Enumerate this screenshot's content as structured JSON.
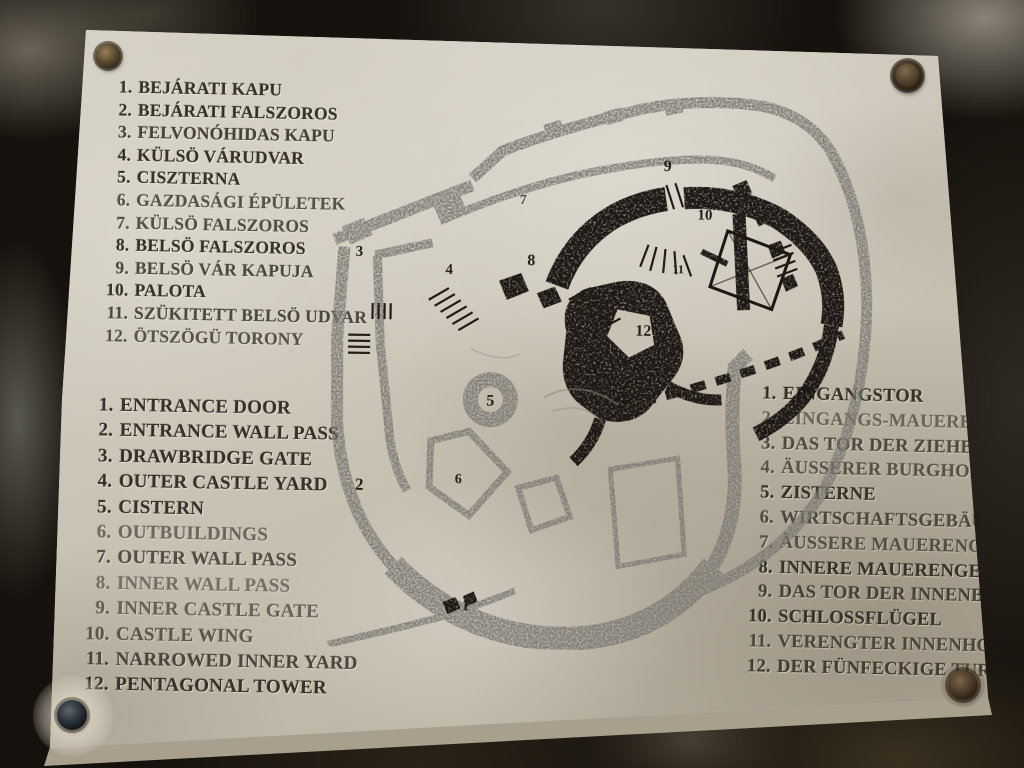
{
  "colors": {
    "plaque_stone": "#ccc6b9",
    "rock_background": "#15110c",
    "outer_wall_gray": "#7b7a74",
    "inner_castle_black": "#1b1712",
    "engraved_text": "#373127"
  },
  "legend_hu": {
    "items": [
      {
        "n": "1.",
        "t": "BEJÁRATI KAPU"
      },
      {
        "n": "2.",
        "t": "BEJÁRATI FALSZOROS"
      },
      {
        "n": "3.",
        "t": "FELVONÓHIDAS KAPU"
      },
      {
        "n": "4.",
        "t": "KÜLSÖ VÁRUDVAR"
      },
      {
        "n": "5.",
        "t": "CISZTERNA"
      },
      {
        "n": "6.",
        "t": "GAZDASÁGI ÉPÜLETEK"
      },
      {
        "n": "7.",
        "t": "KÜLSÖ FALSZOROS"
      },
      {
        "n": "8.",
        "t": "BELSÖ FALSZOROS"
      },
      {
        "n": "9.",
        "t": "BELSÖ VÁR KAPUJA"
      },
      {
        "n": "10.",
        "t": "PALOTA"
      },
      {
        "n": "11.",
        "t": "SZÜKITETT BELSÖ UDVAR"
      },
      {
        "n": "12.",
        "t": "ÖTSZÖGÜ TORONY"
      }
    ]
  },
  "legend_en": {
    "items": [
      {
        "n": "1.",
        "t": "ENTRANCE DOOR"
      },
      {
        "n": "2.",
        "t": "ENTRANCE WALL PASS"
      },
      {
        "n": "3.",
        "t": "DRAWBRIDGE GATE"
      },
      {
        "n": "4.",
        "t": "OUTER CASTLE YARD"
      },
      {
        "n": "5.",
        "t": "CISTERN"
      },
      {
        "n": "6.",
        "t": "OUTBUILDINGS"
      },
      {
        "n": "7.",
        "t": "OUTER WALL PASS"
      },
      {
        "n": "8.",
        "t": "INNER WALL PASS"
      },
      {
        "n": "9.",
        "t": "INNER CASTLE GATE"
      },
      {
        "n": "10.",
        "t": "CASTLE WING"
      },
      {
        "n": "11.",
        "t": "NARROWED INNER YARD"
      },
      {
        "n": "12.",
        "t": "PENTAGONAL TOWER"
      }
    ]
  },
  "legend_de": {
    "items": [
      {
        "n": "1.",
        "t": "EINGANGSTOR"
      },
      {
        "n": "2.",
        "t": "EINGANGS-MAUERENGE"
      },
      {
        "n": "3.",
        "t": "DAS TOR DER ZIEHBRÜCKE"
      },
      {
        "n": "4.",
        "t": "ÄUSSERER BURGHOF"
      },
      {
        "n": "5.",
        "t": "ZISTERNE"
      },
      {
        "n": "6.",
        "t": "WIRTSCHAFTSGEBÄUDE"
      },
      {
        "n": "7.",
        "t": "ÄUSSERE MAUERENGE"
      },
      {
        "n": "8.",
        "t": "INNERE MAUERENGE"
      },
      {
        "n": "9.",
        "t": "DAS TOR DER INNENBURG"
      },
      {
        "n": "10.",
        "t": "SCHLOSSFLÜGEL"
      },
      {
        "n": "11.",
        "t": "VERENGTER INNENHOF"
      },
      {
        "n": "12.",
        "t": "DER FÜNFECKIGE TURM"
      }
    ]
  },
  "map": {
    "labels": [
      {
        "n": "1"
      },
      {
        "n": "2"
      },
      {
        "n": "3"
      },
      {
        "n": "4"
      },
      {
        "n": "5"
      },
      {
        "n": "6"
      },
      {
        "n": "7"
      },
      {
        "n": "8"
      },
      {
        "n": "9"
      },
      {
        "n": "10"
      },
      {
        "n": "11"
      },
      {
        "n": "12"
      }
    ]
  }
}
